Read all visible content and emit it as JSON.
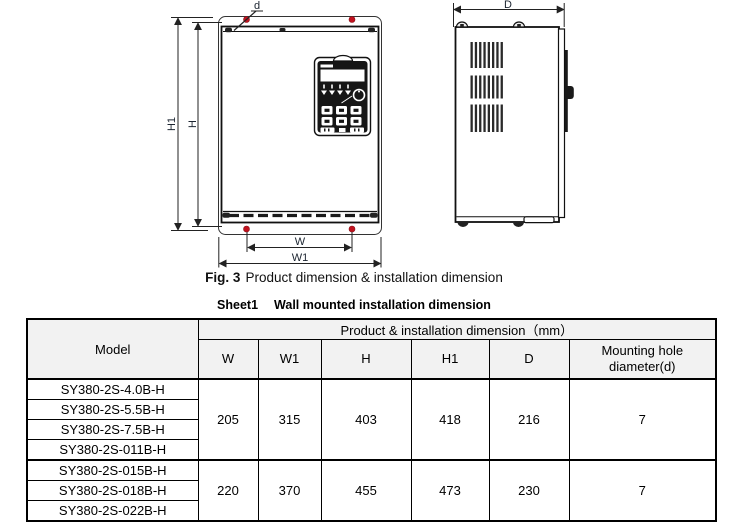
{
  "figure": {
    "caption": {
      "prefix": "Fig. 3",
      "text": "Product dimension & installation dimension"
    },
    "labels": {
      "d": "d",
      "H1": "H1",
      "H": "H",
      "W": "W",
      "W1": "W1",
      "D": "D"
    },
    "colors": {
      "mounting_hole": "#c1121f",
      "line": "#1a1a1a"
    }
  },
  "table": {
    "title": {
      "prefix": "Sheet1",
      "text": "Wall mounted installation dimension"
    },
    "header": {
      "model": "Model",
      "group": "Product & installation dimension（mm）",
      "columns": [
        "W",
        "W1",
        "H",
        "H1",
        "D",
        "Mounting hole diameter(d)"
      ]
    },
    "header_bg": "#f2f2f2",
    "groups": [
      {
        "models": [
          "SY380-2S-4.0B-H",
          "SY380-2S-5.5B-H",
          "SY380-2S-7.5B-H",
          "SY380-2S-011B-H"
        ],
        "values": [
          "205",
          "315",
          "403",
          "418",
          "216",
          "7"
        ]
      },
      {
        "models": [
          "SY380-2S-015B-H",
          "SY380-2S-018B-H",
          "SY380-2S-022B-H"
        ],
        "values": [
          "220",
          "370",
          "455",
          "473",
          "230",
          "7"
        ]
      }
    ]
  }
}
